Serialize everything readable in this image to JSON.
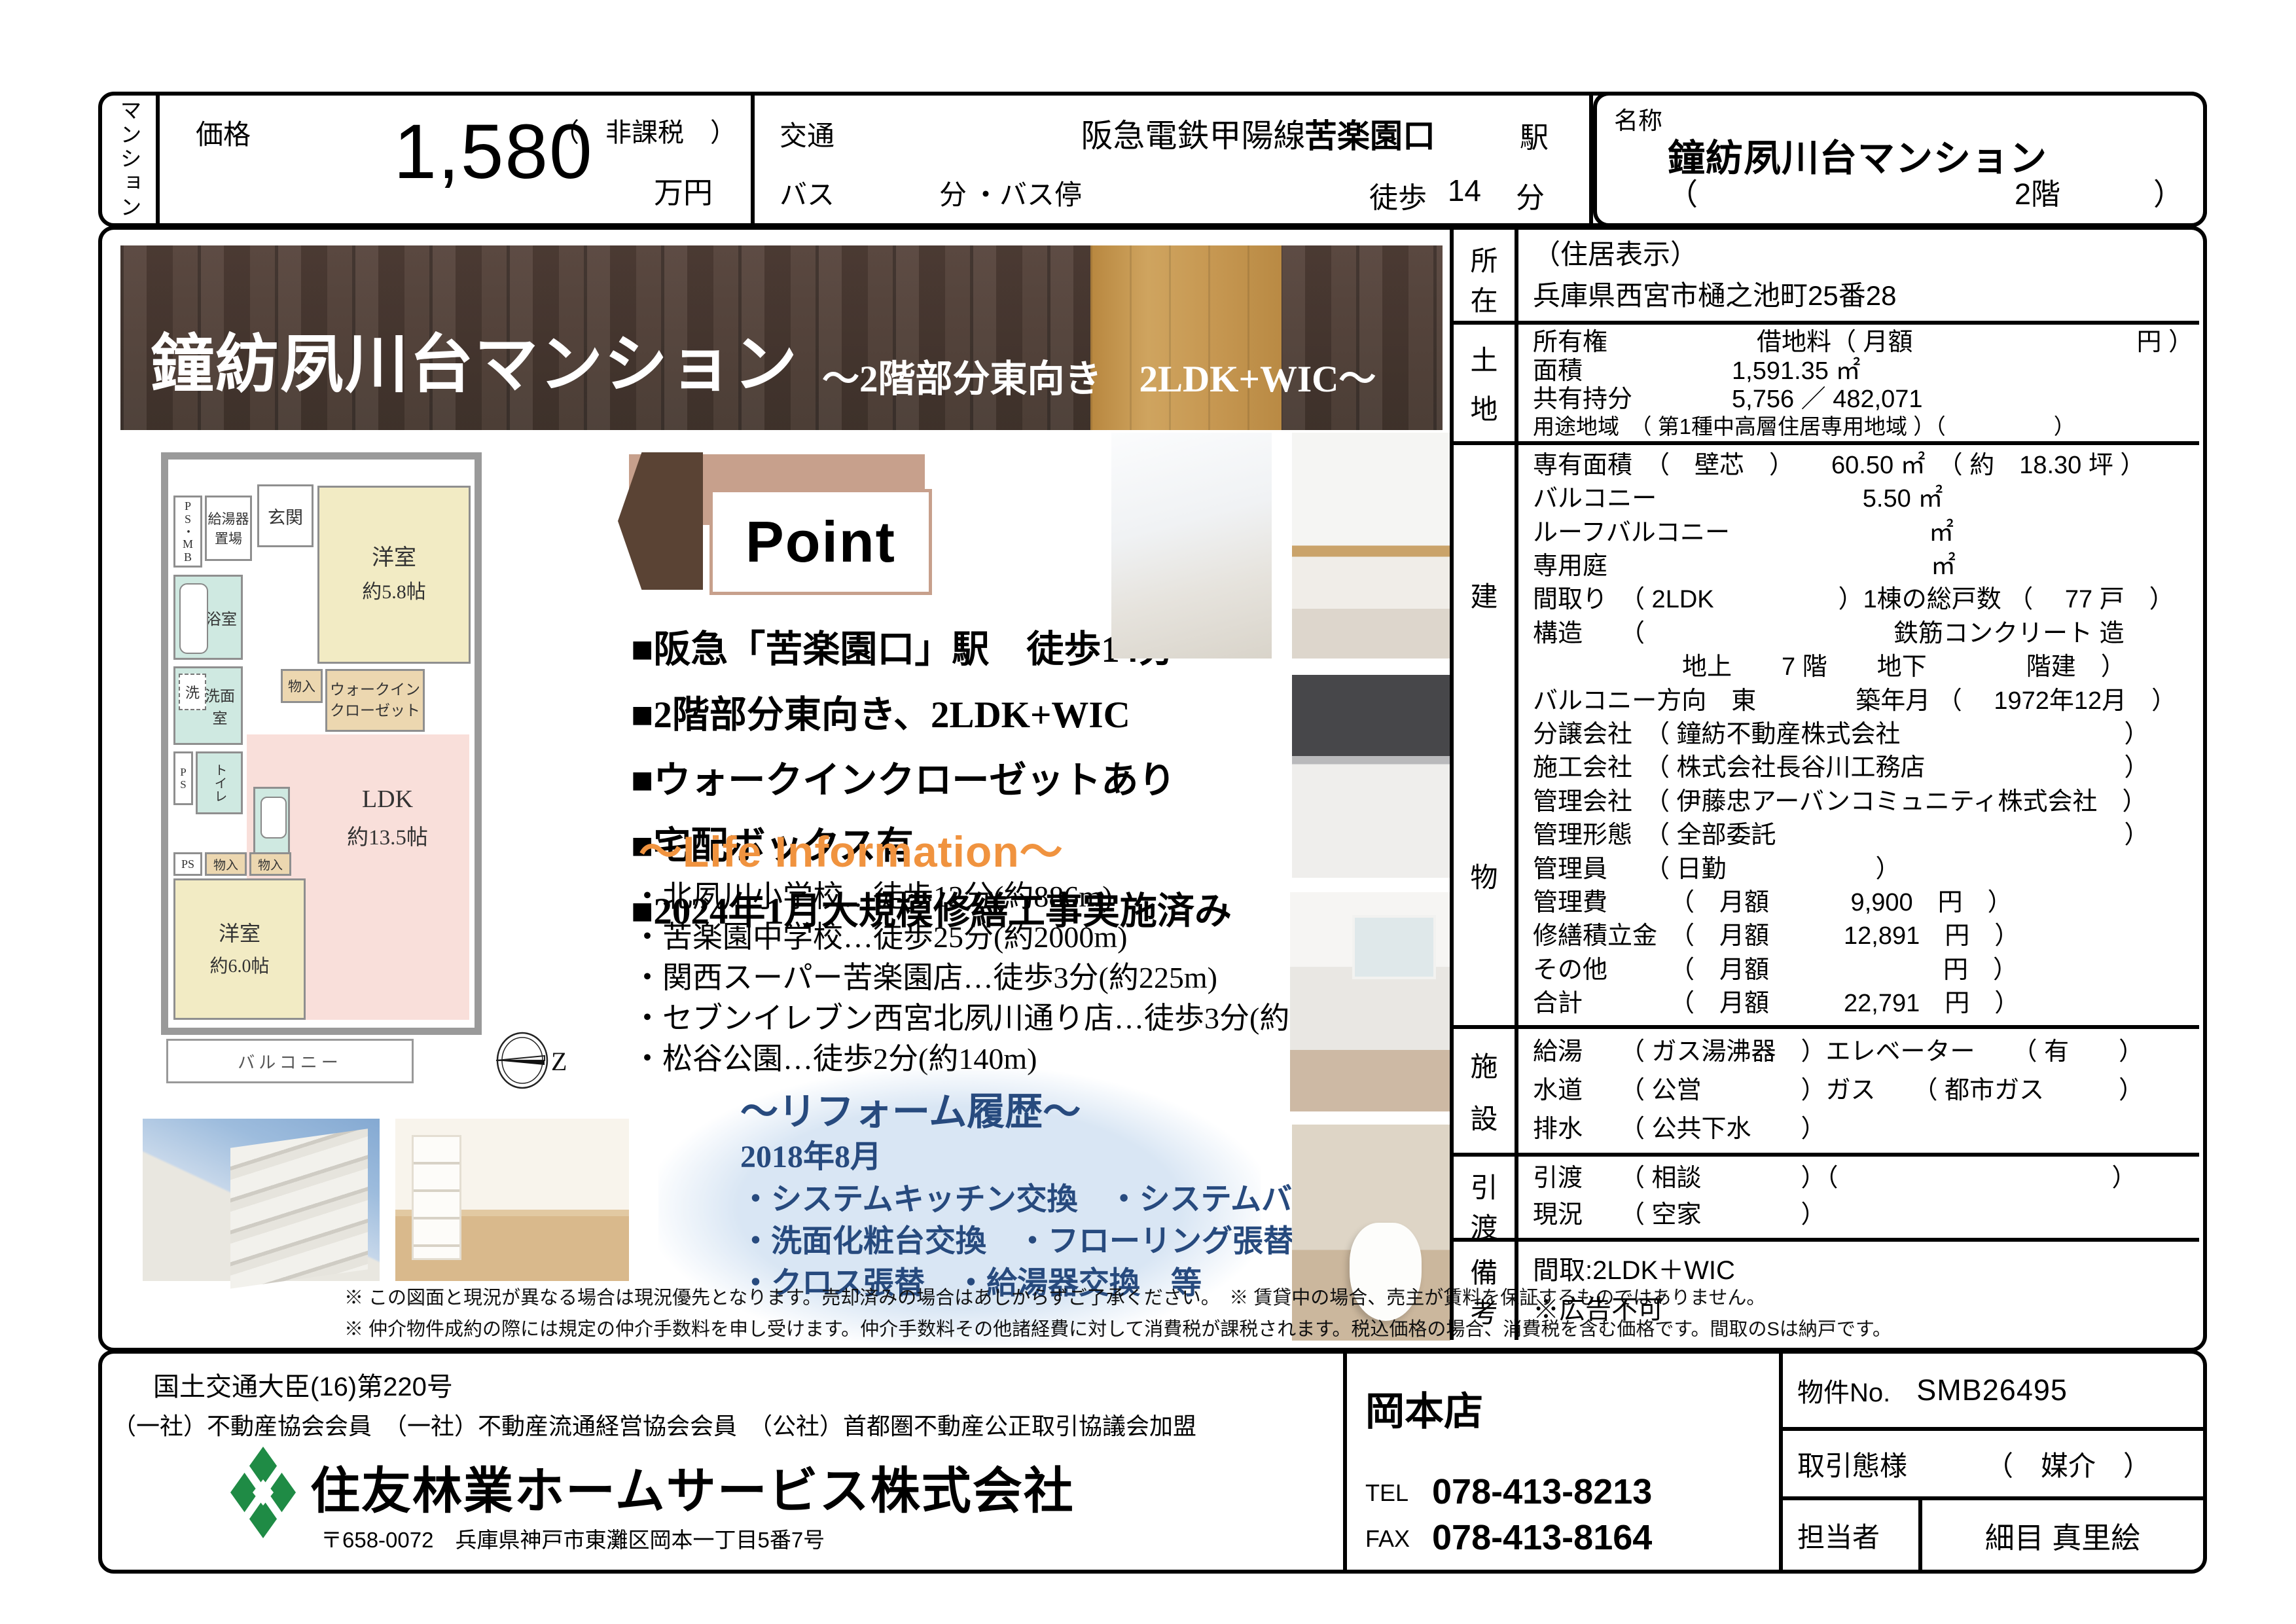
{
  "page": {
    "type_label": "マンション"
  },
  "colors": {
    "accent_orange": "#f0933f",
    "reform_blue": "#274a7e",
    "wood_brown": "#4f3d34",
    "point_tan": "#c7a08c",
    "hexagon_brown": "#5a4334",
    "logo_green": "#1f8b45"
  },
  "header": {
    "price": {
      "label": "価格",
      "value": "1,580",
      "unit": "万円",
      "tax_note": "（　非課税　）"
    },
    "access": {
      "label": "交通",
      "line": "阪急電鉄甲陽線",
      "station": "苦楽園口",
      "station_suffix": "駅",
      "bus_label": "バス",
      "bus_min_label": "分",
      "bus_stop_label": "・バス停",
      "walk_label": "徒歩",
      "walk_min": "14",
      "walk_min_label": "分"
    },
    "name": {
      "label": "名称",
      "value": "鐘紡夙川台マンション",
      "paren_open": "（",
      "floor": "2階",
      "paren_close": "）"
    }
  },
  "banner": {
    "title": "鐘紡夙川台マンション",
    "subtitle": "～2階部分東向き　2LDK+WIC～"
  },
  "floorplan": {
    "psmb": "PS・MB",
    "boiler": "給湯器置場",
    "entrance": "玄関",
    "western1": "洋室",
    "western1_size": "約5.8帖",
    "bath": "浴室",
    "wash": "洗",
    "washroom": "洗面室",
    "ps1": "PS",
    "toilet": "トイレ",
    "storage1": "物入",
    "wic1": "ウォークイン",
    "wic2": "クローゼット",
    "ldk": "LDK",
    "ldk_size": "約13.5帖",
    "western2": "洋室",
    "western2_size": "約6.0帖",
    "ps2": "PS",
    "storage2": "物入",
    "storage3": "物入",
    "balcony": "バルコニー",
    "compass_letter": "Z"
  },
  "point": {
    "title": "Point",
    "bullets": [
      "■阪急「苦楽園口」駅　徒歩14分",
      "■2階部分東向き、2LDK+WIC",
      "■ウォークインクローゼットあり",
      "■宅配ボックス有",
      "■2024年1月大規模修繕工事実施済み"
    ]
  },
  "life_info": {
    "title": "～Life Information～",
    "items": [
      "・北夙川小学校…徒歩12分(約886m)",
      "・苦楽園中学校…徒歩25分(約2000m)",
      "・関西スーパー苦楽園店…徒歩3分(約225m)",
      "・セブンイレブン西宮北夙川通り店…徒歩3分(約220m)",
      "・松谷公園…徒歩2分(約140m)"
    ]
  },
  "reform": {
    "title": "～リフォーム履歴～",
    "date": "2018年8月",
    "items": [
      "・システムキッチン交換　・システムバス交換",
      "・洗面化粧台交換　・フローリング張替",
      "・クロス張替　・給湯器交換　等"
    ]
  },
  "details": {
    "sections": [
      {
        "id": "shozai",
        "label_chars": [
          "所",
          "在"
        ],
        "rows": [
          "（住居表示）",
          "兵庫県西宮市樋之池町25番28"
        ]
      },
      {
        "id": "tochi",
        "label_chars": [
          "土",
          "地"
        ],
        "rows": [
          "所有権　　　　　　借地料（ 月額　　　　　　　　　円 ）",
          "面積　　　　　　1,591.35 ㎡",
          "共有持分　　　　5,756 ／ 482,071",
          "用途地域　（ 第1種中高層住居専用地域 ）（　　　　　）"
        ]
      },
      {
        "id": "tatemono",
        "label_chars": [
          "建",
          "物"
        ],
        "rows": [
          "専有面積　（　壁芯　）　　60.50 ㎡　（ 約　18.30 坪 ）",
          "バルコニー　　　　　　　　 5.50 ㎡",
          "ルーフバルコニー　　　　　　　　㎡",
          "専用庭　　　　　　　　　　　　　㎡",
          "間取り　（ 2LDK　　　　　）1棟の総戸数 （　 77 戸　）",
          "構造　　（　　　　　　　　　　鉄筋コンクリート 造",
          "　　　　　　地上　　7 階　　地下　　　　階建　）",
          "バルコニー方向　東　　　　築年月 （　 1972年12月　）",
          "分譲会社　（ 鐘紡不動産株式会社　　　　　　　　　）",
          "施工会社　（ 株式会社長谷川工務店　　　　　　　　）",
          "管理会社　（ 伊藤忠アーバンコミュニティ株式会社　）",
          "管理形態　（ 全部委託　　　　　　　　　　　　　　）",
          "管理員　　（ 日勤　　　　　　）",
          "管理費　　　（　月額　　　 9,900　円　）",
          "修繕積立金　（　月額　　　12,891　円　）",
          "その他　　　（　月額　　　　　　　円　）",
          "合計　　　　（　月額　　　22,791　円　）"
        ]
      },
      {
        "id": "shisetsu",
        "label_chars": [
          "施",
          "設"
        ],
        "rows": [
          "給湯　　（ ガス湯沸器　）エレベーター　　（ 有　　）",
          "水道　　（ 公営　　　　）ガス　　（ 都市ガス　　　）",
          "排水　　（ 公共下水　　）"
        ]
      },
      {
        "id": "hikiwatashi",
        "label_chars": [
          "引",
          "渡"
        ],
        "rows": [
          "引渡　　（ 相談　　　　）（　　　　　　　　　　　）",
          "現況　　（ 空家　　　　）"
        ]
      },
      {
        "id": "bikou",
        "label_chars": [
          "備",
          "考"
        ],
        "rows": [
          "間取:2LDK＋WIC",
          "※広告不可"
        ]
      }
    ]
  },
  "disclaimer": [
    "※ この図面と現況が異なる場合は現況優先となります。売却済みの場合はあしからずご了承ください。　※ 賃貸中の場合、売主が賃料を保証するものではありません。",
    "※ 仲介物件成約の際には規定の仲介手数料を申し受けます。仲介手数料その他諸経費に対して消費税が課税されます。税込価格の場合、消費税を含む価格です。間取のSは納戸です。"
  ],
  "footer": {
    "license": "国土交通大臣(16)第220号",
    "memberships": "（一社）不動産協会会員　（一社）不動産流通経営協会会員　（公社）首都圏不動産公正取引協議会加盟",
    "company": "住友林業ホームサービス株式会社",
    "address": "〒658-0072　兵庫県神戸市東灘区岡本一丁目5番7号",
    "branch": "岡本店",
    "tel_label": "TEL",
    "tel": "078-413-8213",
    "fax_label": "FAX",
    "fax": "078-413-8164",
    "property_no_label": "物件No.",
    "property_no": "SMB26495",
    "transaction_label": "取引態様",
    "transaction": "（　媒介　）",
    "agent_label": "担当者",
    "agent": "細目 真里絵"
  }
}
